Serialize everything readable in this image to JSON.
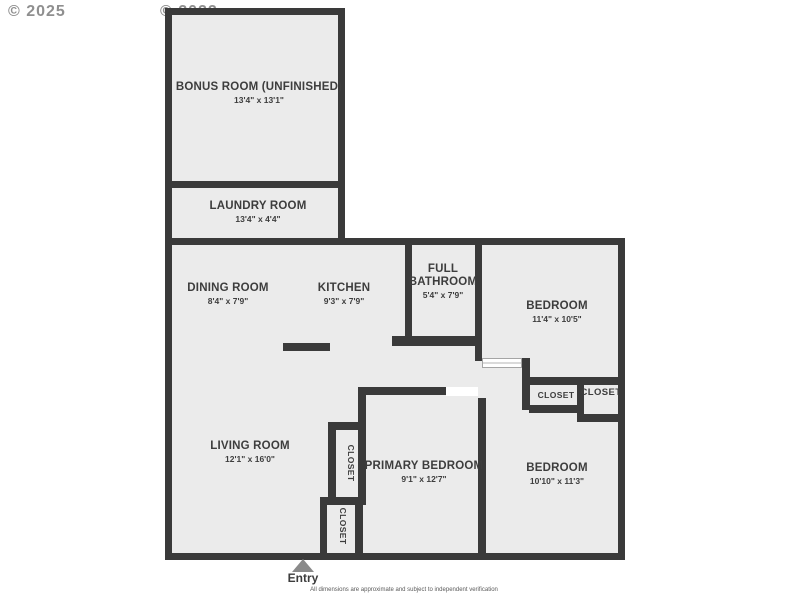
{
  "watermarks": {
    "left": "© 2025",
    "right": "© 2022"
  },
  "rooms": {
    "bonus": {
      "name": "BONUS ROOM (UNFINISHED)",
      "dims": "13'4\" x 13'1\""
    },
    "laundry": {
      "name": "LAUNDRY ROOM",
      "dims": "13'4\" x 4'4\""
    },
    "dining": {
      "name": "DINING ROOM",
      "dims": "8'4\" x 7'9\""
    },
    "kitchen": {
      "name": "KITCHEN",
      "dims": "9'3\" x 7'9\""
    },
    "bathroom": {
      "name": "FULL BATHROOM",
      "dims": "5'4\" x 7'9\""
    },
    "bedroom1": {
      "name": "BEDROOM",
      "dims": "11'4\" x 10'5\""
    },
    "living": {
      "name": "LIVING ROOM",
      "dims": "12'1\" x 16'0\""
    },
    "primary": {
      "name": "PRIMARY BEDROOM",
      "dims": "9'1\" x 12'7\""
    },
    "bedroom2": {
      "name": "BEDROOM",
      "dims": "10'10\" x 11'3\""
    }
  },
  "closets": {
    "hall": "CLOSET",
    "hall2": "CLOSET",
    "mid": "CLOSET",
    "entry": "CLOSET"
  },
  "entry_label": "Entry",
  "disclaimer": "All dimensions are approximate and subject to independent verification",
  "colors": {
    "wall": "#3a3a3a",
    "room_fill": "#ebebeb",
    "text": "#3d3d3d",
    "watermark": "#8f8f8f"
  }
}
